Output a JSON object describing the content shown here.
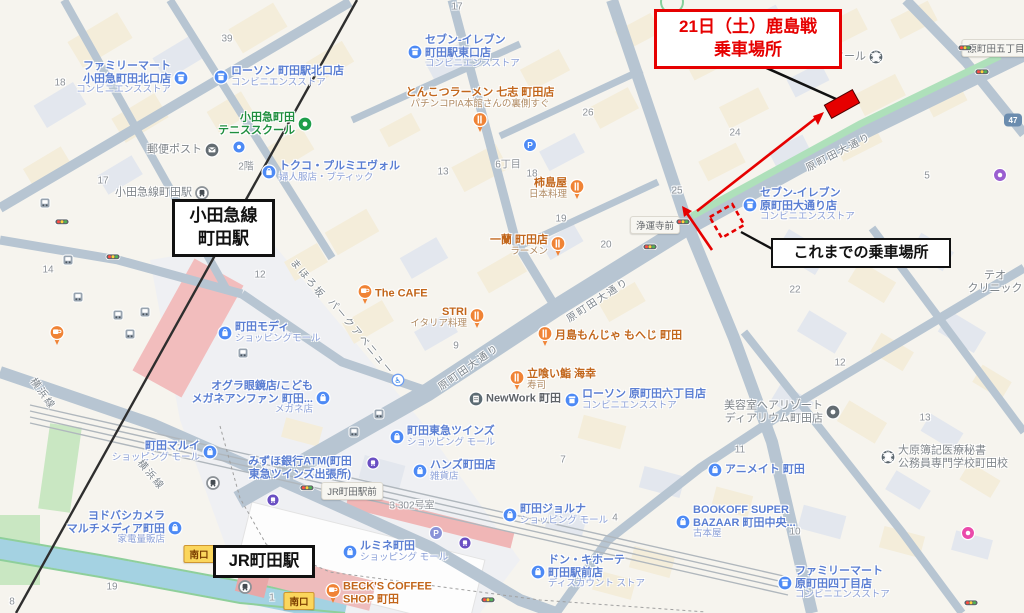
{
  "overlays": {
    "new_pickup": {
      "line1": "21日（土）鹿島戦",
      "line2": "乗車場所"
    },
    "previous_pickup": {
      "text": "これまでの乗車場所"
    },
    "odakyu_station": {
      "line1": "小田急線",
      "line2": "町田駅"
    },
    "jr_station": {
      "text": "JR町田駅"
    },
    "colors": {
      "annotation_red": "#e60000",
      "annotation_black": "#111111"
    }
  },
  "map": {
    "colors": {
      "road": "#b7c5d2",
      "green_stripe": "#aee0ba",
      "poi_blue": "#4d8af5",
      "poi_orange": "#f08335",
      "station_pink": "#f2bdbd",
      "water": "#a4d2e2"
    },
    "pois": [
      {
        "id": "familymart-odakyu-kitaguchi",
        "lines": [
          "ファミリーマート",
          "小田急町田北口店"
        ],
        "sub": "コンビニエンスストア",
        "color": "blue",
        "icon": "convenience-store",
        "x": 181,
        "y": 78,
        "side": "left"
      },
      {
        "id": "lawson-kitaguchi",
        "lines": [
          "ローソン 町田駅北口店"
        ],
        "sub": "コンビニエンスストア",
        "color": "blue",
        "icon": "convenience-store",
        "x": 221,
        "y": 77,
        "side": "right"
      },
      {
        "id": "seveneleven-higashiguchi",
        "lines": [
          "セブン-イレブン",
          "町田駅東口店"
        ],
        "sub": "コンビニエンスストア",
        "color": "blue",
        "icon": "convenience-store",
        "x": 415,
        "y": 52,
        "side": "right"
      },
      {
        "id": "odakyu-tennis-school",
        "lines": [
          "小田急町田",
          "テニススクール"
        ],
        "sub": "",
        "color": "green",
        "icon": "tennis",
        "x": 305,
        "y": 124,
        "side": "left"
      },
      {
        "id": "post-box",
        "lines": [
          "郵便ポスト"
        ],
        "sub": "",
        "color": "gray",
        "icon": "post",
        "x": 212,
        "y": 150,
        "side": "left"
      },
      {
        "id": "cycle-spot",
        "lines": [],
        "sub": "",
        "color": "blue",
        "icon": "blue-dot",
        "x": 239,
        "y": 147,
        "side": "none"
      },
      {
        "id": "tokuko-premier-vol",
        "lines": [
          "トクコ・プルミエヴォル"
        ],
        "sub": "婦人服店・ブティック",
        "color": "blue",
        "icon": "shopping",
        "x": 269,
        "y": 172,
        "side": "right"
      },
      {
        "id": "tonkotsu-nanashi",
        "lines": [
          "とんこつラーメン 七志 町田店"
        ],
        "sub": "パチンコPIA本館さんの裏側すぐ",
        "color": "orange",
        "icon": "food-pin",
        "x": 480,
        "y": 122,
        "side": "top"
      },
      {
        "id": "seveneleven-haramachida",
        "lines": [
          "セブン-イレブン",
          "原町田大通り店"
        ],
        "sub": "コンビニエンスストア",
        "color": "blue",
        "icon": "convenience-store",
        "x": 750,
        "y": 205,
        "side": "right"
      },
      {
        "id": "kakishimaya",
        "lines": [
          "柿島屋"
        ],
        "sub": "日本料理",
        "color": "orange",
        "icon": "food-pin",
        "x": 577,
        "y": 189,
        "side": "left"
      },
      {
        "id": "ichiran-machida",
        "lines": [
          "一蘭 町田店"
        ],
        "sub": "ラーメン",
        "color": "orange",
        "icon": "food-pin",
        "x": 558,
        "y": 246,
        "side": "left"
      },
      {
        "id": "the-cafe",
        "lines": [
          "The CAFE"
        ],
        "sub": "",
        "color": "orange",
        "icon": "cafe-pin",
        "x": 365,
        "y": 294,
        "side": "right"
      },
      {
        "id": "stri",
        "lines": [
          "STRI"
        ],
        "sub": "イタリア料理",
        "color": "orange",
        "icon": "food-pin",
        "x": 477,
        "y": 318,
        "side": "left"
      },
      {
        "id": "tsukishima-monja-moheji",
        "lines": [
          "月島もんじゃ もへじ 町田"
        ],
        "sub": "",
        "color": "orange",
        "icon": "food-pin",
        "x": 545,
        "y": 336,
        "side": "right"
      },
      {
        "id": "tachigui-sushi-kaiko",
        "lines": [
          "立喰い鮨 海幸"
        ],
        "sub": "寿司",
        "color": "orange",
        "icon": "food-pin",
        "x": 517,
        "y": 380,
        "side": "right"
      },
      {
        "id": "newwork-machida",
        "lines": [
          "NewWork 町田"
        ],
        "sub": "",
        "color": "dark",
        "icon": "office",
        "x": 476,
        "y": 399,
        "side": "right"
      },
      {
        "id": "lawson-haramachida6",
        "lines": [
          "ローソン 原町田六丁目店"
        ],
        "sub": "コンビニエンスストア",
        "color": "blue",
        "icon": "convenience-store",
        "x": 572,
        "y": 400,
        "side": "right"
      },
      {
        "id": "machida-modi",
        "lines": [
          "町田モディ"
        ],
        "sub": "ショッピングモール",
        "color": "blue",
        "icon": "shopping",
        "x": 225,
        "y": 333,
        "side": "right"
      },
      {
        "id": "ogura-megane",
        "lines": [
          "オグラ眼鏡店/こども",
          "メガネアンファン 町田..."
        ],
        "sub": "メガネ店",
        "color": "blue",
        "icon": "shopping",
        "x": 323,
        "y": 398,
        "side": "left"
      },
      {
        "id": "mizuho-atm",
        "lines": [
          "みずほ銀行ATM(町田",
          "東急ツインズ出張所)"
        ],
        "sub": "",
        "color": "blue",
        "icon": "none",
        "x": 300,
        "y": 468,
        "side": "text"
      },
      {
        "id": "tokyu-twins",
        "lines": [
          "町田東急ツインズ"
        ],
        "sub": "ショッピング モール",
        "color": "blue",
        "icon": "shopping",
        "x": 397,
        "y": 437,
        "side": "right"
      },
      {
        "id": "hands-machida",
        "lines": [
          "ハンズ町田店"
        ],
        "sub": "雑貨店",
        "color": "blue",
        "icon": "shopping",
        "x": 420,
        "y": 471,
        "side": "right"
      },
      {
        "id": "machida-marui",
        "lines": [
          "町田マルイ"
        ],
        "sub": "ショッピング モール",
        "color": "blue",
        "icon": "shopping",
        "x": 210,
        "y": 452,
        "side": "left"
      },
      {
        "id": "yodobashi-camera",
        "lines": [
          "ヨドバシカメラ",
          "マルチメディア町田"
        ],
        "sub": "家電量販店",
        "color": "blue",
        "icon": "shopping",
        "x": 175,
        "y": 528,
        "side": "left"
      },
      {
        "id": "machida-jorna",
        "lines": [
          "町田ジョルナ"
        ],
        "sub": "ショッピング モール",
        "color": "blue",
        "icon": "shopping",
        "x": 510,
        "y": 515,
        "side": "right"
      },
      {
        "id": "lumine-machida",
        "lines": [
          "ルミネ町田"
        ],
        "sub": "ショッピング モール",
        "color": "blue",
        "icon": "shopping",
        "x": 350,
        "y": 552,
        "side": "right"
      },
      {
        "id": "don-quijote",
        "lines": [
          "ドン・キホーテ",
          "町田駅前店"
        ],
        "sub": "ディスカウント ストア",
        "color": "blue",
        "icon": "shopping",
        "x": 538,
        "y": 572,
        "side": "right"
      },
      {
        "id": "becks-coffee",
        "lines": [
          "BECK'S COFFEE",
          "SHOP 町田"
        ],
        "sub": "",
        "color": "orange",
        "icon": "cafe-pin",
        "x": 333,
        "y": 593,
        "side": "right"
      },
      {
        "id": "animate-machida",
        "lines": [
          "アニメイト 町田"
        ],
        "sub": "",
        "color": "blue",
        "icon": "shopping",
        "x": 715,
        "y": 470,
        "side": "right"
      },
      {
        "id": "bookoff-super-bazaar",
        "lines": [
          "BOOKOFF SUPER",
          "BAZAAR 町田中央..."
        ],
        "sub": "古本屋",
        "color": "blue",
        "icon": "shopping",
        "x": 683,
        "y": 522,
        "side": "right"
      },
      {
        "id": "familymart-haramachida4",
        "lines": [
          "ファミリーマート",
          "原町田四丁目店"
        ],
        "sub": "コンビニエンスストア",
        "color": "blue",
        "icon": "convenience-store",
        "x": 785,
        "y": 583,
        "side": "right"
      },
      {
        "id": "ohara-gakko",
        "lines": [
          "大原簿記医療秘書",
          "公務員専門学校町田校"
        ],
        "sub": "",
        "color": "gray",
        "icon": "school",
        "x": 888,
        "y": 457,
        "side": "right"
      },
      {
        "id": "hair-resort-diarium",
        "lines": [
          "美容室ヘアリゾート",
          "ディアリウム町田店"
        ],
        "sub": "",
        "color": "gray",
        "icon": "scissors",
        "x": 833,
        "y": 412,
        "side": "left"
      },
      {
        "id": "teo-clinic",
        "lines": [
          "テオ",
          "クリニック"
        ],
        "sub": "",
        "color": "gray",
        "icon": "none",
        "x": 995,
        "y": 282,
        "side": "text"
      },
      {
        "id": "school-partial",
        "lines": [
          "スクール"
        ],
        "sub": "",
        "color": "gray",
        "icon": "school",
        "x": 876,
        "y": 57,
        "side": "left"
      },
      {
        "id": "odakyu-line-machida-sta",
        "lines": [
          "小田急線町田駅"
        ],
        "sub": "",
        "color": "gray",
        "icon": "station",
        "x": 202,
        "y": 193,
        "side": "left"
      },
      {
        "id": "cafe-unnamed",
        "lines": [],
        "sub": "",
        "color": "orange",
        "icon": "cafe-pin",
        "x": 57,
        "y": 335,
        "side": "none"
      }
    ],
    "chips": [
      {
        "t": "原町田五丁目",
        "x": 996,
        "y": 48,
        "s": "gray"
      },
      {
        "t": "浄運寺前",
        "x": 655,
        "y": 225,
        "s": "gray"
      },
      {
        "t": "JR町田駅前",
        "x": 352,
        "y": 491,
        "s": "gray"
      },
      {
        "t": "南口",
        "x": 199,
        "y": 554,
        "s": "yellow"
      },
      {
        "t": "南口",
        "x": 299,
        "y": 601,
        "s": "yellow"
      }
    ],
    "street_names": [
      {
        "t": "原町田大通り",
        "x": 838,
        "y": 151,
        "r": -27
      },
      {
        "t": "原町田大通り",
        "x": 597,
        "y": 299,
        "r": -33
      },
      {
        "t": "原町田大通り",
        "x": 468,
        "y": 366,
        "r": -35
      },
      {
        "t": "パークアベニュー",
        "x": 362,
        "y": 336,
        "r": 50
      },
      {
        "t": "まほろ坂",
        "x": 309,
        "y": 278,
        "r": 50
      },
      {
        "t": "横浜線",
        "x": 44,
        "y": 393,
        "r": 55
      },
      {
        "t": "横浜線",
        "x": 152,
        "y": 474,
        "r": 50
      }
    ],
    "numbers": [
      {
        "t": "17",
        "x": 103,
        "y": 181
      },
      {
        "t": "18",
        "x": 60,
        "y": 83
      },
      {
        "t": "39",
        "x": 227,
        "y": 39
      },
      {
        "t": "17",
        "x": 457,
        "y": 7
      },
      {
        "t": "13",
        "x": 443,
        "y": 172
      },
      {
        "t": "6丁目",
        "x": 508,
        "y": 163
      },
      {
        "t": "18",
        "x": 532,
        "y": 174
      },
      {
        "t": "19",
        "x": 561,
        "y": 219
      },
      {
        "t": "20",
        "x": 606,
        "y": 245
      },
      {
        "t": "26",
        "x": 588,
        "y": 113
      },
      {
        "t": "27",
        "x": 661,
        "y": 64
      },
      {
        "t": "24",
        "x": 735,
        "y": 133
      },
      {
        "t": "25",
        "x": 677,
        "y": 191
      },
      {
        "t": "5",
        "x": 927,
        "y": 176
      },
      {
        "t": "22",
        "x": 795,
        "y": 290
      },
      {
        "t": "14",
        "x": 48,
        "y": 270
      },
      {
        "t": "12",
        "x": 260,
        "y": 275
      },
      {
        "t": "9",
        "x": 456,
        "y": 346
      },
      {
        "t": "7",
        "x": 563,
        "y": 460
      },
      {
        "t": "4",
        "x": 615,
        "y": 518
      },
      {
        "t": "11",
        "x": 740,
        "y": 450
      },
      {
        "t": "10",
        "x": 795,
        "y": 532
      },
      {
        "t": "12",
        "x": 840,
        "y": 363
      },
      {
        "t": "13",
        "x": 925,
        "y": 418
      },
      {
        "t": "19",
        "x": 112,
        "y": 587
      },
      {
        "t": "1",
        "x": 272,
        "y": 598
      },
      {
        "t": "8",
        "x": 12,
        "y": 602
      },
      {
        "t": "2階",
        "x": 246,
        "y": 165
      },
      {
        "t": "3 302号室",
        "x": 412,
        "y": 504
      }
    ],
    "furniture": {
      "traffic_lights": [
        [
          62,
          222
        ],
        [
          113,
          257
        ],
        [
          650,
          247
        ],
        [
          683,
          222
        ],
        [
          965,
          48
        ],
        [
          982,
          72
        ],
        [
          488,
          600
        ],
        [
          971,
          603
        ],
        [
          307,
          488
        ]
      ],
      "bus_stops": [
        [
          45,
          203
        ],
        [
          68,
          260
        ],
        [
          78,
          297
        ],
        [
          118,
          315
        ],
        [
          145,
          312
        ],
        [
          130,
          334
        ],
        [
          243,
          353
        ],
        [
          379,
          414
        ],
        [
          354,
          432
        ]
      ],
      "stations": [
        [
          213,
          483
        ],
        [
          245,
          587
        ]
      ],
      "rail_purple": [
        [
          373,
          463
        ],
        [
          465,
          543
        ],
        [
          273,
          500
        ]
      ],
      "purple_shop": [
        [
          1000,
          175
        ]
      ],
      "pink_shop": [
        [
          968,
          533
        ]
      ],
      "parking_blue": [
        [
          530,
          145
        ]
      ],
      "parking_purple": [
        [
          436,
          533
        ]
      ],
      "wheelchair": [
        [
          398,
          380
        ]
      ]
    },
    "route_shield": {
      "text": "47",
      "x": 1013,
      "y": 120
    }
  }
}
